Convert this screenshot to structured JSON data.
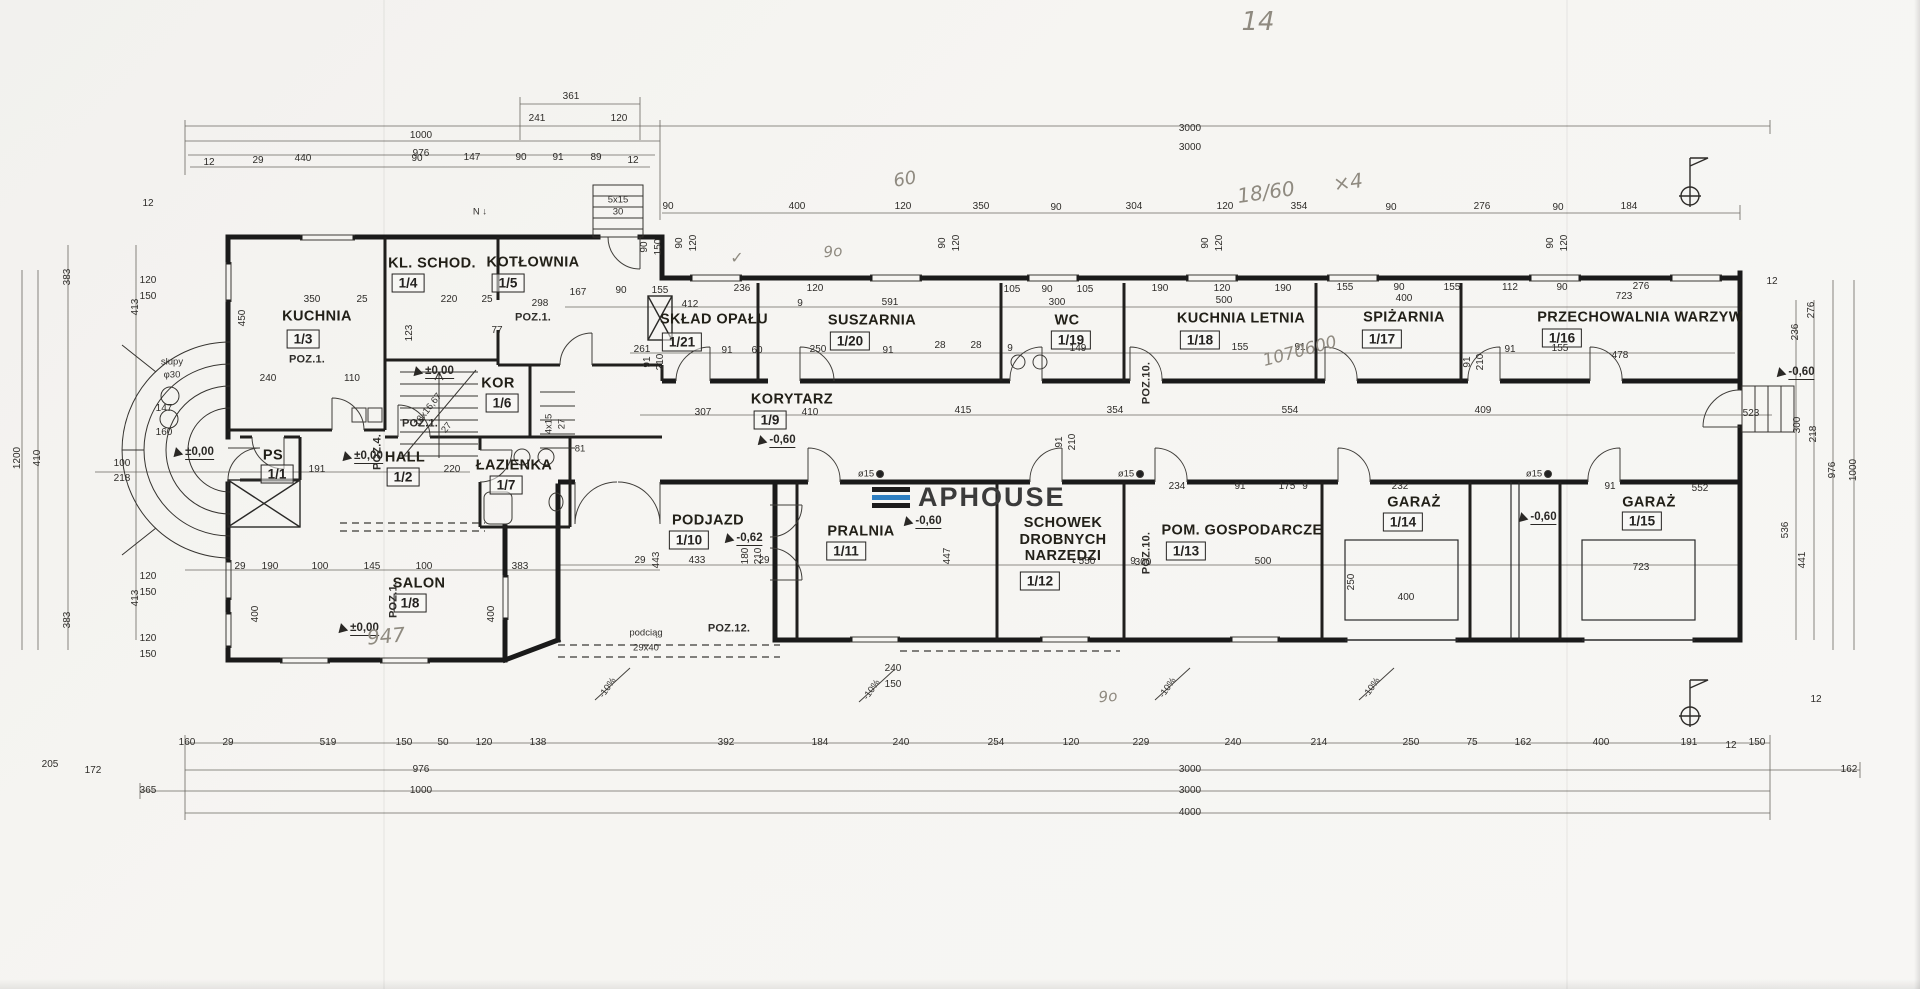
{
  "logo": {
    "text": "APHOUSE",
    "bar_top": "#1c1c1c",
    "bar_mid": "#2e7fc1",
    "bar_bot": "#1c1c1c"
  },
  "rooms": [
    {
      "name": "PS",
      "num": "1/1",
      "x": 273,
      "y": 456,
      "bx": 277,
      "by": 474
    },
    {
      "name": "HALL",
      "num": "1/2",
      "x": 405,
      "y": 458,
      "bx": 403,
      "by": 477
    },
    {
      "name": "KUCHNIA",
      "num": "1/3",
      "x": 317,
      "y": 317,
      "bx": 303,
      "by": 339
    },
    {
      "name": "KL. SCHOD.",
      "num": "1/4",
      "x": 432,
      "y": 264,
      "bx": 408,
      "by": 283
    },
    {
      "name": "KOTŁOWNIA",
      "num": "1/5",
      "x": 533,
      "y": 263,
      "bx": 508,
      "by": 283
    },
    {
      "name": "KOR",
      "num": "1/6",
      "x": 498,
      "y": 384,
      "bx": 502,
      "by": 403
    },
    {
      "name": "ŁAZIENKA",
      "num": "1/7",
      "x": 514,
      "y": 466,
      "bx": 506,
      "by": 485
    },
    {
      "name": "SALON",
      "num": "1/8",
      "x": 419,
      "y": 584,
      "bx": 410,
      "by": 603
    },
    {
      "name": "KORYTARZ",
      "num": "1/9",
      "x": 792,
      "y": 400,
      "bx": 770,
      "by": 420
    },
    {
      "name": "PODJAZD",
      "num": "1/10",
      "x": 708,
      "y": 521,
      "bx": 689,
      "by": 540
    },
    {
      "name": "PRALNIA",
      "num": "1/11",
      "x": 861,
      "y": 532,
      "bx": 846,
      "by": 551
    },
    {
      "name": "SCHOWEK\nDROBNYCH\nNARZĘDZI",
      "num": "1/12",
      "x": 1063,
      "y": 540,
      "bx": 1040,
      "by": 581
    },
    {
      "name": "POM. GOSPODARCZE",
      "num": "1/13",
      "x": 1242,
      "y": 531,
      "bx": 1186,
      "by": 551
    },
    {
      "name": "GARAŻ",
      "num": "1/14",
      "x": 1414,
      "y": 503,
      "bx": 1403,
      "by": 522
    },
    {
      "name": "GARAŻ",
      "num": "1/15",
      "x": 1649,
      "y": 503,
      "bx": 1642,
      "by": 521
    },
    {
      "name": "PRZECHOWALNIA WARZYW",
      "num": "1/16",
      "x": 1640,
      "y": 318,
      "bx": 1562,
      "by": 338
    },
    {
      "name": "SPIŻARNIA",
      "num": "1/17",
      "x": 1404,
      "y": 318,
      "bx": 1382,
      "by": 339
    },
    {
      "name": "KUCHNIA LETNIA",
      "num": "1/18",
      "x": 1241,
      "y": 319,
      "bx": 1200,
      "by": 340
    },
    {
      "name": "WC",
      "num": "1/19",
      "x": 1067,
      "y": 321,
      "bx": 1071,
      "by": 340
    },
    {
      "name": "SUSZARNIA",
      "num": "1/20",
      "x": 872,
      "y": 321,
      "bx": 850,
      "by": 341
    },
    {
      "name": "SKŁAD OPAŁU",
      "num": "1/21",
      "x": 714,
      "y": 320,
      "bx": 682,
      "by": 342
    }
  ],
  "levels": [
    {
      "t": "±0,00",
      "x": 193,
      "y": 452
    },
    {
      "t": "±0,00",
      "x": 362,
      "y": 456
    },
    {
      "t": "±0,00",
      "x": 433,
      "y": 371
    },
    {
      "t": "±0,00",
      "x": 358,
      "y": 628
    },
    {
      "t": "-0,60",
      "x": 776,
      "y": 440
    },
    {
      "t": "-0,60",
      "x": 922,
      "y": 521
    },
    {
      "t": "-0,60",
      "x": 1537,
      "y": 517
    },
    {
      "t": "-0,60",
      "x": 1795,
      "y": 372
    },
    {
      "t": "-0,62",
      "x": 743,
      "y": 538
    }
  ],
  "labels": [
    [
      "361",
      571,
      97,
      0,
      "dim"
    ],
    [
      "241",
      537,
      119,
      0,
      "dim"
    ],
    [
      "120",
      619,
      119,
      0,
      "dim"
    ],
    [
      "1000",
      421,
      136,
      0,
      "dim"
    ],
    [
      "976",
      421,
      154,
      0,
      "dim"
    ],
    [
      "12",
      209,
      163,
      0,
      "dim"
    ],
    [
      "29",
      258,
      161,
      0,
      "dim"
    ],
    [
      "440",
      303,
      159,
      0,
      "dim"
    ],
    [
      "90",
      417,
      159,
      0,
      "dim"
    ],
    [
      "147",
      472,
      158,
      0,
      "dim"
    ],
    [
      "90",
      521,
      158,
      0,
      "dim"
    ],
    [
      "91",
      558,
      158,
      0,
      "dim"
    ],
    [
      "89",
      596,
      158,
      0,
      "dim"
    ],
    [
      "12",
      633,
      161,
      0,
      "dim"
    ],
    [
      "3000",
      1190,
      129,
      0,
      "dim"
    ],
    [
      "3000",
      1190,
      148,
      0,
      "dim"
    ],
    [
      "90",
      668,
      207,
      0,
      "dim"
    ],
    [
      "400",
      797,
      207,
      0,
      "dim"
    ],
    [
      "120",
      903,
      207,
      0,
      "dim"
    ],
    [
      "350",
      981,
      207,
      0,
      "dim"
    ],
    [
      "90",
      1056,
      208,
      0,
      "dim"
    ],
    [
      "304",
      1134,
      207,
      0,
      "dim"
    ],
    [
      "120",
      1225,
      207,
      0,
      "dim"
    ],
    [
      "354",
      1299,
      207,
      0,
      "dim"
    ],
    [
      "90",
      1391,
      208,
      0,
      "dim"
    ],
    [
      "276",
      1482,
      207,
      0,
      "dim"
    ],
    [
      "90",
      1558,
      208,
      0,
      "dim"
    ],
    [
      "184",
      1629,
      207,
      0,
      "dim"
    ],
    [
      "90",
      680,
      243,
      -90,
      "dim"
    ],
    [
      "120",
      694,
      243,
      -90,
      "dim"
    ],
    [
      "90",
      943,
      243,
      -90,
      "dim"
    ],
    [
      "120",
      957,
      243,
      -90,
      "dim"
    ],
    [
      "90",
      1206,
      243,
      -90,
      "dim"
    ],
    [
      "120",
      1220,
      243,
      -90,
      "dim"
    ],
    [
      "90",
      1551,
      243,
      -90,
      "dim"
    ],
    [
      "120",
      1565,
      243,
      -90,
      "dim"
    ],
    [
      "90",
      645,
      247,
      -90,
      "dim"
    ],
    [
      "150",
      659,
      247,
      -90,
      "dim"
    ],
    [
      "1200",
      18,
      458,
      -90,
      "dim"
    ],
    [
      "410",
      38,
      458,
      -90,
      "dim"
    ],
    [
      "383",
      68,
      277,
      -90,
      "dim"
    ],
    [
      "413",
      136,
      307,
      -90,
      "dim"
    ],
    [
      "12",
      148,
      204,
      0,
      "dim"
    ],
    [
      "120",
      148,
      281,
      0,
      "dim"
    ],
    [
      "150",
      148,
      297,
      0,
      "dim"
    ],
    [
      "147",
      164,
      409,
      0,
      "dim"
    ],
    [
      "160",
      164,
      433,
      0,
      "dim"
    ],
    [
      "120",
      148,
      577,
      0,
      "dim"
    ],
    [
      "150",
      148,
      593,
      0,
      "dim"
    ],
    [
      "413",
      136,
      598,
      -90,
      "dim"
    ],
    [
      "383",
      68,
      620,
      -90,
      "dim"
    ],
    [
      "120",
      148,
      639,
      0,
      "dim"
    ],
    [
      "150",
      148,
      655,
      0,
      "dim"
    ],
    [
      "205",
      50,
      765,
      0,
      "dim"
    ],
    [
      "172",
      93,
      771,
      0,
      "dim"
    ],
    [
      "365",
      148,
      791,
      0,
      "dim"
    ],
    [
      "160",
      187,
      743,
      0,
      "dim"
    ],
    [
      "29",
      228,
      743,
      0,
      "dim"
    ],
    [
      "519",
      328,
      743,
      0,
      "dim"
    ],
    [
      "150",
      404,
      743,
      0,
      "dim"
    ],
    [
      "50",
      443,
      743,
      0,
      "dim"
    ],
    [
      "120",
      484,
      743,
      0,
      "dim"
    ],
    [
      "138",
      538,
      743,
      0,
      "dim"
    ],
    [
      "392",
      726,
      743,
      0,
      "dim"
    ],
    [
      "184",
      820,
      743,
      0,
      "dim"
    ],
    [
      "240",
      901,
      743,
      0,
      "dim"
    ],
    [
      "254",
      996,
      743,
      0,
      "dim"
    ],
    [
      "120",
      1071,
      743,
      0,
      "dim"
    ],
    [
      "229",
      1141,
      743,
      0,
      "dim"
    ],
    [
      "240",
      1233,
      743,
      0,
      "dim"
    ],
    [
      "214",
      1319,
      743,
      0,
      "dim"
    ],
    [
      "250",
      1411,
      743,
      0,
      "dim"
    ],
    [
      "75",
      1472,
      743,
      0,
      "dim"
    ],
    [
      "162",
      1523,
      743,
      0,
      "dim"
    ],
    [
      "400",
      1601,
      743,
      0,
      "dim"
    ],
    [
      "191",
      1689,
      743,
      0,
      "dim"
    ],
    [
      "12",
      1731,
      746,
      0,
      "dim"
    ],
    [
      "150",
      1757,
      743,
      0,
      "dim"
    ],
    [
      "976",
      421,
      770,
      0,
      "dim"
    ],
    [
      "3000",
      1190,
      770,
      0,
      "dim"
    ],
    [
      "162",
      1849,
      770,
      0,
      "dim"
    ],
    [
      "1000",
      421,
      791,
      0,
      "dim"
    ],
    [
      "3000",
      1190,
      791,
      0,
      "dim"
    ],
    [
      "4000",
      1190,
      813,
      0,
      "dim"
    ],
    [
      "276",
      1812,
      310,
      -90,
      "dim"
    ],
    [
      "12",
      1772,
      282,
      0,
      "dim"
    ],
    [
      "236",
      1796,
      332,
      -90,
      "dim"
    ],
    [
      "300",
      1798,
      425,
      -90,
      "dim"
    ],
    [
      "218",
      1814,
      434,
      -90,
      "dim"
    ],
    [
      "976",
      1833,
      470,
      -90,
      "dim"
    ],
    [
      "1000",
      1854,
      470,
      -90,
      "dim"
    ],
    [
      "536",
      1786,
      530,
      -90,
      "dim"
    ],
    [
      "441",
      1803,
      560,
      -90,
      "dim"
    ],
    [
      "12",
      1816,
      700,
      0,
      "dim"
    ],
    [
      "167",
      578,
      293,
      0,
      "dim"
    ],
    [
      "90",
      621,
      291,
      0,
      "dim"
    ],
    [
      "155",
      660,
      291,
      0,
      "dim"
    ],
    [
      "236",
      742,
      289,
      0,
      "dim"
    ],
    [
      "120",
      815,
      289,
      0,
      "dim"
    ],
    [
      "412",
      690,
      305,
      0,
      "dim"
    ],
    [
      "9",
      800,
      304,
      0,
      "dim"
    ],
    [
      "591",
      890,
      303,
      0,
      "dim"
    ],
    [
      "105",
      1012,
      290,
      0,
      "dim"
    ],
    [
      "90",
      1047,
      290,
      0,
      "dim"
    ],
    [
      "105",
      1085,
      290,
      0,
      "dim"
    ],
    [
      "300",
      1057,
      303,
      0,
      "dim"
    ],
    [
      "190",
      1160,
      289,
      0,
      "dim"
    ],
    [
      "120",
      1222,
      289,
      0,
      "dim"
    ],
    [
      "190",
      1283,
      289,
      0,
      "dim"
    ],
    [
      "500",
      1224,
      301,
      0,
      "dim"
    ],
    [
      "155",
      1345,
      288,
      0,
      "dim"
    ],
    [
      "90",
      1399,
      288,
      0,
      "dim"
    ],
    [
      "155",
      1452,
      288,
      0,
      "dim"
    ],
    [
      "400",
      1404,
      299,
      0,
      "dim"
    ],
    [
      "112",
      1510,
      288,
      0,
      "dim"
    ],
    [
      "90",
      1562,
      288,
      0,
      "dim"
    ],
    [
      "276",
      1641,
      287,
      0,
      "dim"
    ],
    [
      "723",
      1624,
      297,
      0,
      "dim"
    ],
    [
      "261",
      642,
      350,
      0,
      "dim"
    ],
    [
      "91",
      727,
      351,
      0,
      "dim"
    ],
    [
      "60",
      757,
      351,
      0,
      "dim"
    ],
    [
      "250",
      818,
      350,
      0,
      "dim"
    ],
    [
      "91",
      888,
      351,
      0,
      "dim"
    ],
    [
      "28",
      940,
      346,
      0,
      "dim"
    ],
    [
      "28",
      976,
      346,
      0,
      "dim"
    ],
    [
      "149",
      1078,
      349,
      0,
      "dim"
    ],
    [
      "9",
      1010,
      349,
      0,
      "dim"
    ],
    [
      "155",
      1240,
      348,
      0,
      "dim"
    ],
    [
      "91",
      1300,
      348,
      0,
      "dim"
    ],
    [
      "91",
      1510,
      350,
      0,
      "dim"
    ],
    [
      "155",
      1560,
      349,
      0,
      "dim"
    ],
    [
      "478",
      1620,
      356,
      0,
      "dim"
    ],
    [
      "307",
      703,
      413,
      0,
      "dim"
    ],
    [
      "410",
      810,
      413,
      0,
      "dim"
    ],
    [
      "415",
      963,
      411,
      0,
      "dim"
    ],
    [
      "354",
      1115,
      411,
      0,
      "dim"
    ],
    [
      "554",
      1290,
      411,
      0,
      "dim"
    ],
    [
      "409",
      1483,
      411,
      0,
      "dim"
    ],
    [
      "523",
      1751,
      414,
      0,
      "dim"
    ],
    [
      "91",
      648,
      362,
      -90,
      "dim"
    ],
    [
      "210",
      661,
      362,
      -90,
      "dim"
    ],
    [
      "91",
      1060,
      442,
      -90,
      "dim"
    ],
    [
      "210",
      1073,
      442,
      -90,
      "dim"
    ],
    [
      "91",
      1468,
      362,
      -90,
      "dim"
    ],
    [
      "210",
      1481,
      362,
      -90,
      "dim"
    ],
    [
      "180",
      746,
      556,
      -90,
      "dim"
    ],
    [
      "210",
      759,
      556,
      -90,
      "dim"
    ],
    [
      "433",
      697,
      561,
      0,
      "dim"
    ],
    [
      "443",
      657,
      560,
      -90,
      "dim"
    ],
    [
      "29",
      640,
      561,
      0,
      "dim"
    ],
    [
      "29",
      764,
      561,
      0,
      "dim"
    ],
    [
      "550",
      1087,
      562,
      0,
      "dim"
    ],
    [
      "9",
      1133,
      562,
      0,
      "dim"
    ],
    [
      "447",
      948,
      556,
      -90,
      "dim"
    ],
    [
      "300",
      1143,
      563,
      0,
      "dim"
    ],
    [
      "500",
      1263,
      562,
      0,
      "dim"
    ],
    [
      "234",
      1177,
      487,
      0,
      "dim"
    ],
    [
      "91",
      1240,
      487,
      0,
      "dim"
    ],
    [
      "175",
      1287,
      487,
      0,
      "dim"
    ],
    [
      "9",
      1305,
      487,
      0,
      "dim"
    ],
    [
      "232",
      1400,
      487,
      0,
      "dim"
    ],
    [
      "91",
      1610,
      487,
      0,
      "dim"
    ],
    [
      "552",
      1700,
      489,
      0,
      "dim"
    ],
    [
      "400",
      1406,
      598,
      0,
      "dim"
    ],
    [
      "723",
      1641,
      568,
      0,
      "dim"
    ],
    [
      "240",
      893,
      669,
      0,
      "dim"
    ],
    [
      "150",
      893,
      685,
      0,
      "dim"
    ],
    [
      "250",
      1352,
      582,
      -90,
      "dim"
    ],
    [
      "350",
      312,
      300,
      0,
      "dim"
    ],
    [
      "25",
      362,
      300,
      0,
      "dim"
    ],
    [
      "220",
      449,
      300,
      0,
      "dim"
    ],
    [
      "25",
      487,
      300,
      0,
      "dim"
    ],
    [
      "240",
      268,
      379,
      0,
      "dim"
    ],
    [
      "110",
      352,
      379,
      0,
      "dim"
    ],
    [
      "450",
      243,
      318,
      -90,
      "dim"
    ],
    [
      "298",
      540,
      304,
      0,
      "dim"
    ],
    [
      "77",
      497,
      331,
      0,
      "dim"
    ],
    [
      "123",
      410,
      333,
      -90,
      "dim"
    ],
    [
      "191",
      317,
      470,
      0,
      "dim"
    ],
    [
      "220",
      452,
      470,
      0,
      "dim"
    ],
    [
      "100",
      122,
      464,
      0,
      "dim"
    ],
    [
      "218",
      122,
      479,
      0,
      "dim"
    ],
    [
      "29",
      240,
      567,
      0,
      "dim"
    ],
    [
      "190",
      270,
      567,
      0,
      "dim"
    ],
    [
      "100",
      320,
      567,
      0,
      "dim"
    ],
    [
      "145",
      372,
      567,
      0,
      "dim"
    ],
    [
      "100",
      424,
      567,
      0,
      "dim"
    ],
    [
      "383",
      520,
      567,
      0,
      "dim"
    ],
    [
      "400",
      256,
      614,
      -90,
      "dim"
    ],
    [
      "400",
      492,
      614,
      -90,
      "dim"
    ],
    [
      "słupy",
      172,
      362,
      0,
      "misc"
    ],
    [
      "φ30",
      172,
      375,
      0,
      "misc"
    ],
    [
      "N ↓",
      480,
      212,
      0,
      "misc"
    ],
    [
      "18x16,67",
      428,
      410,
      -52,
      "misc"
    ],
    [
      "27",
      447,
      428,
      -52,
      "misc"
    ],
    [
      "5x15",
      618,
      200,
      0,
      "misc"
    ],
    [
      "30",
      618,
      212,
      0,
      "misc"
    ],
    [
      "4x15",
      549,
      424,
      -90,
      "misc"
    ],
    [
      "27",
      562,
      424,
      -90,
      "misc"
    ],
    [
      "81",
      580,
      449,
      0,
      "misc"
    ],
    [
      "ø15",
      866,
      474,
      0,
      "misc"
    ],
    [
      "ø15",
      1126,
      474,
      0,
      "misc"
    ],
    [
      "ø15",
      1534,
      474,
      0,
      "misc"
    ],
    [
      "-10%",
      608,
      688,
      -55,
      "misc"
    ],
    [
      "-10%",
      872,
      690,
      -55,
      "misc"
    ],
    [
      "-10%",
      1168,
      688,
      -55,
      "misc"
    ],
    [
      "-10%",
      1372,
      688,
      -55,
      "misc"
    ],
    [
      "podciąg",
      646,
      633,
      0,
      "misc"
    ],
    [
      "29x40",
      646,
      648,
      0,
      "misc"
    ],
    [
      "POZ.1.",
      307,
      360,
      0,
      "poz"
    ],
    [
      "POZ.1.",
      533,
      318,
      0,
      "poz"
    ],
    [
      "POZ.1.",
      420,
      424,
      0,
      "poz"
    ],
    [
      "POZ.1.",
      394,
      600,
      -90,
      "poz"
    ],
    [
      "POZ.4.",
      378,
      452,
      -90,
      "poz"
    ],
    [
      "POZ.10.",
      1147,
      383,
      -90,
      "poz"
    ],
    [
      "POZ.10.",
      1147,
      553,
      -90,
      "poz"
    ],
    [
      "POZ.12.",
      729,
      629,
      0,
      "poz"
    ],
    [
      "14",
      1258,
      22,
      0,
      "hand",
      26
    ],
    [
      "60",
      905,
      180,
      -10,
      "hand",
      18
    ],
    [
      "18/60",
      1266,
      192,
      -8,
      "hand",
      20
    ],
    [
      "×4",
      1348,
      182,
      -8,
      "hand",
      20
    ],
    [
      "✓",
      737,
      258,
      0,
      "hand",
      16
    ],
    [
      "9o",
      833,
      252,
      -5,
      "hand",
      15
    ],
    [
      "1070600",
      1300,
      352,
      -15,
      "hand",
      17
    ],
    [
      "947",
      386,
      636,
      -5,
      "hand",
      20
    ],
    [
      "9o",
      1108,
      697,
      -5,
      "hand",
      15
    ]
  ]
}
